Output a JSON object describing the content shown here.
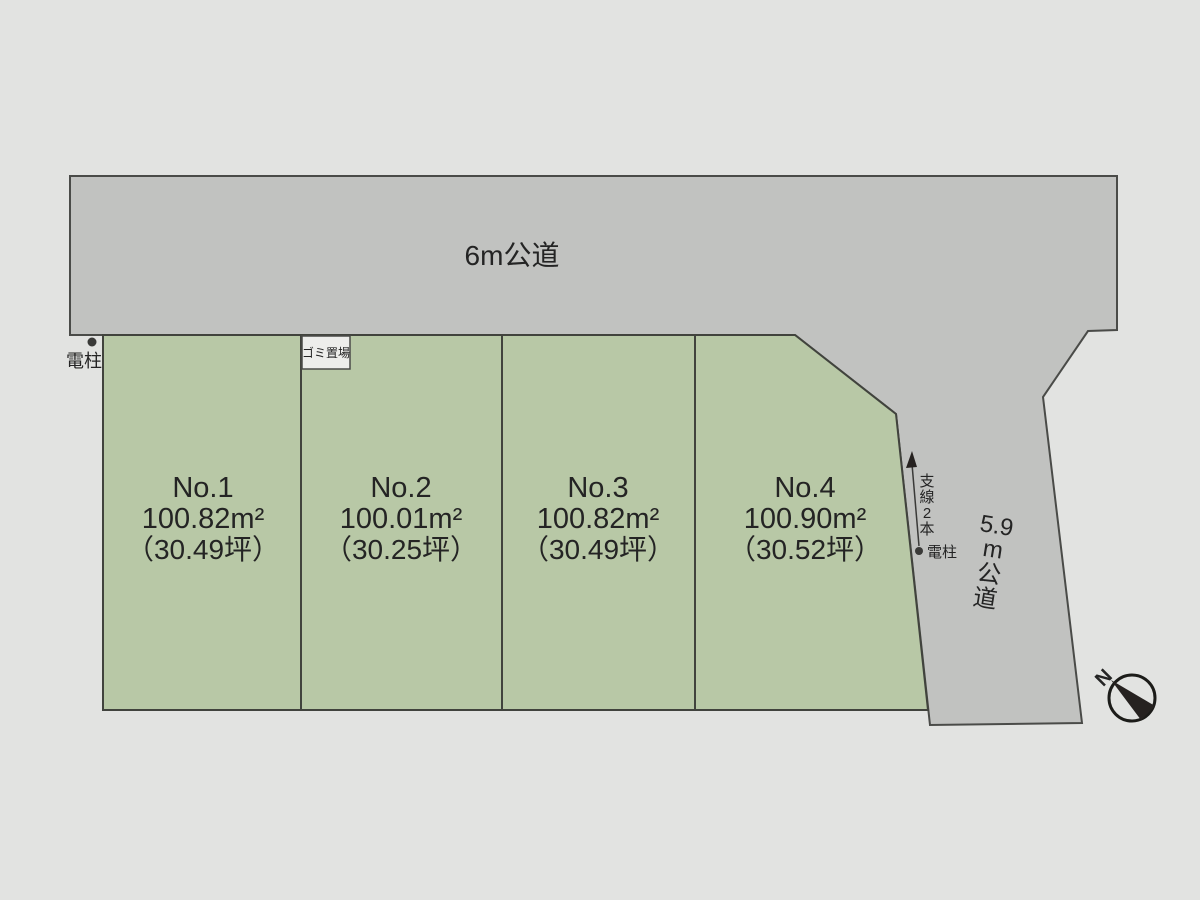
{
  "roads": {
    "top": {
      "label": "6m公道"
    },
    "side": {
      "label": "5.9m公道",
      "label_parts": [
        "5.9",
        "m",
        "公",
        "道"
      ]
    }
  },
  "plots": [
    {
      "name": "No.1",
      "area": "100.82m²",
      "tsubo": "（30.49坪）"
    },
    {
      "name": "No.2",
      "area": "100.01m²",
      "tsubo": "（30.25坪）"
    },
    {
      "name": "No.3",
      "area": "100.82m²",
      "tsubo": "（30.49坪）"
    },
    {
      "name": "No.4",
      "area": "100.90m²",
      "tsubo": "（30.52坪）"
    }
  ],
  "annotations": {
    "pole_left": {
      "label": "電柱"
    },
    "garbage": {
      "label": "ゴミ置場"
    },
    "wires": {
      "label": "支線2本",
      "parts": [
        "支",
        "線",
        "2",
        "本"
      ]
    },
    "pole_right": {
      "label": "電柱"
    },
    "compass": {
      "label": "N"
    }
  },
  "colors": {
    "background": "#e2e3e1",
    "road": "#c1c2c0",
    "plot_green": "#b8c8a6",
    "line": "#41433d",
    "text": "#242424"
  }
}
